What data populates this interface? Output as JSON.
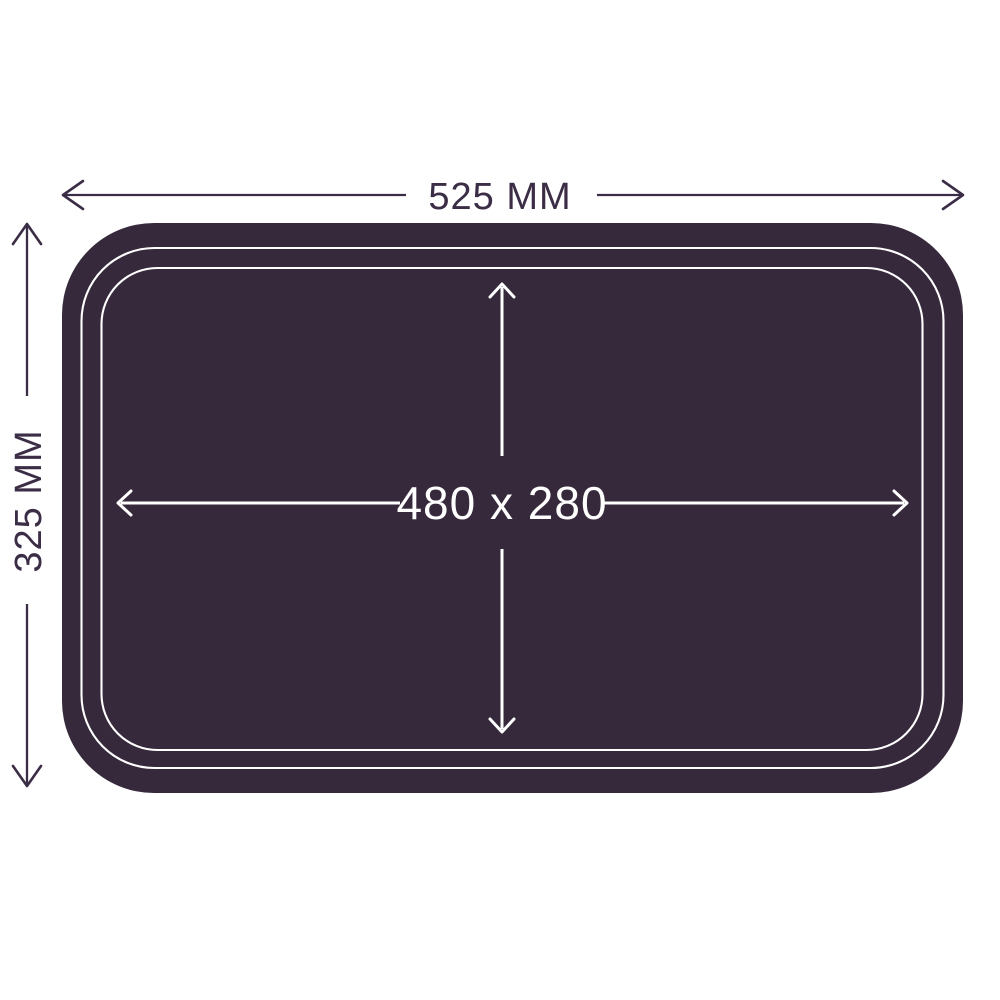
{
  "colors": {
    "background": "#ffffff",
    "tray": "#36293b",
    "dimension": "#3b2d45",
    "outline": "#ffffff"
  },
  "labels": {
    "outer_width": "525 MM",
    "outer_height": "325 MM",
    "inner_size": "480 x 280"
  }
}
